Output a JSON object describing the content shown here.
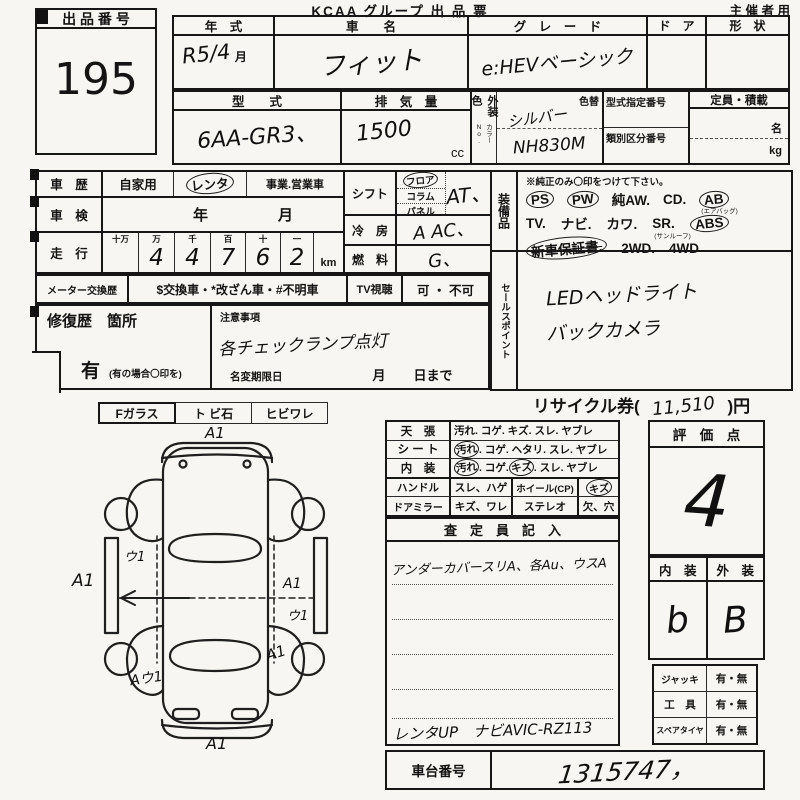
{
  "header": {
    "title": "KCAA グループ 出 品 票",
    "audience": "主 催 者 用"
  },
  "lot": {
    "label": "出 品 番 号",
    "number": "195"
  },
  "row1": {
    "year_label": "年　式",
    "year_value": "R5/4",
    "year_month": "月",
    "name_label": "車　　名",
    "name_value": "フィット",
    "grade_label": "グ　レ　ー　ド",
    "grade_value": "e:HEVベーシック",
    "door_label": "ド　ア",
    "shape_label": "形　状"
  },
  "row2": {
    "model_label": "型　　式",
    "model_value": "6AA-GR3、",
    "disp_label": "排　気　量",
    "disp_value": "1500",
    "disp_unit": "cc",
    "color_label": "外装色",
    "color_no": "カラーNo.",
    "color_change": "色替",
    "color_value": "シルバー",
    "color_code": "NH830M",
    "typeno_label": "型式指定番号",
    "classno_label": "類別区分番号",
    "cap_label": "定員・積載",
    "cap_unit1": "名",
    "cap_unit2": "kg"
  },
  "history": {
    "label": "車　歴",
    "own": "自家用",
    "rental": "レンタ",
    "business": "事業.営業車",
    "inspection_label": "車　検",
    "inspection_year": "年",
    "inspection_month": "月",
    "mileage_label": "走　行",
    "digit_headers": [
      "十万",
      "万",
      "千",
      "百",
      "十",
      "一"
    ],
    "digits": [
      "",
      "4",
      "4",
      "7",
      "6",
      "2"
    ],
    "km": "km",
    "meter_label": "メーター交換歴",
    "meter_options": "$交換車・*改ざん車・#不明車",
    "tv_label": "TV視聴",
    "tv_options": "可 ・ 不可"
  },
  "specs": {
    "shift_label": "シフト",
    "shift_floor": "フロア",
    "shift_column": "コラム",
    "shift_panel": "パネル",
    "shift_value": "AT、",
    "ac_label": "冷　房",
    "ac_value": "A AC、",
    "fuel_label": "燃　料",
    "fuel_value": "G、"
  },
  "equipment": {
    "label": "装備品",
    "note": "※純正のみ〇印をつけて下さい。",
    "ps": "PS",
    "pw": "PW",
    "aw": "純AW.",
    "cd": "CD.",
    "ab": "AB",
    "ab_sub": "(エアバッグ)",
    "tv": "TV.",
    "navi": "ナビ.",
    "kawa": "カワ.",
    "sr": "SR.",
    "sr_sub": "(サンルーフ)",
    "abs": "ABS",
    "warranty": "新車保証書.",
    "wd2": "2WD.",
    "wd4": "4WD"
  },
  "sales": {
    "label": "セールスポイント",
    "line1": "LEDヘッドライト",
    "line2": "バックカメラ"
  },
  "repair": {
    "label": "修復歴　箇所",
    "note_label": "注意事項",
    "note_value": "各チェックランプ点灯",
    "yes": "有",
    "yes_note": "(有の場合〇印を)",
    "rename_label": "名変期限日",
    "month": "月",
    "day": "日まで"
  },
  "recycle": {
    "prefix": "リサイクル券(",
    "amount": "11,510",
    "suffix": ")円"
  },
  "condition": {
    "ceiling_label": "天　張",
    "ceiling_opts": "汚れ. コゲ. キズ. スレ. ヤブレ",
    "seat_label": "シ ー ト",
    "seat_c1": "汚れ",
    "seat_rest": ". コゲ. ヘタリ. スレ. ヤブレ",
    "interior_label": "内　装",
    "int_c1": "汚れ",
    "int_mid": ". コゲ. ",
    "int_c2": "キズ",
    "int_rest": ". スレ. ヤブレ",
    "handle_label": "ハンドル",
    "handle_opts": "スレ、ハゲ",
    "wheel_label": "ホイール(CP)",
    "wheel_val": "キズ",
    "mirror_label": "ドアミラー",
    "mirror_opts": "キズ、ワレ",
    "stereo_label": "ステレオ",
    "stereo_val": "欠、穴",
    "inspector_header": "査　定　員　記　入",
    "note1": "アンダーカバースリA、各Au、ウスA",
    "note2": "レンタUP　ナビAVIC-RZ113"
  },
  "rating": {
    "label": "評　価　点",
    "score": "4",
    "interior_label": "内　装",
    "exterior_label": "外　装",
    "interior_score": "b",
    "exterior_score": "B"
  },
  "accessories": {
    "jack_label": "ジャッキ",
    "jack_opts": "有・無",
    "tool_label": "工　具",
    "tool_opts": "有・無",
    "spare_label": "スペアタイヤ",
    "spare_opts": "有・無"
  },
  "chassis": {
    "label": "車台番号",
    "value": "1315747，"
  },
  "glass": {
    "f": "Fガラス",
    "stone": "ト ビ石",
    "crack": "ヒビワレ"
  },
  "diagram": {
    "annotations": [
      "A1",
      "ウ1",
      "A1",
      "A1",
      "ウ1",
      "A1",
      "Aウ1",
      "A1"
    ]
  }
}
